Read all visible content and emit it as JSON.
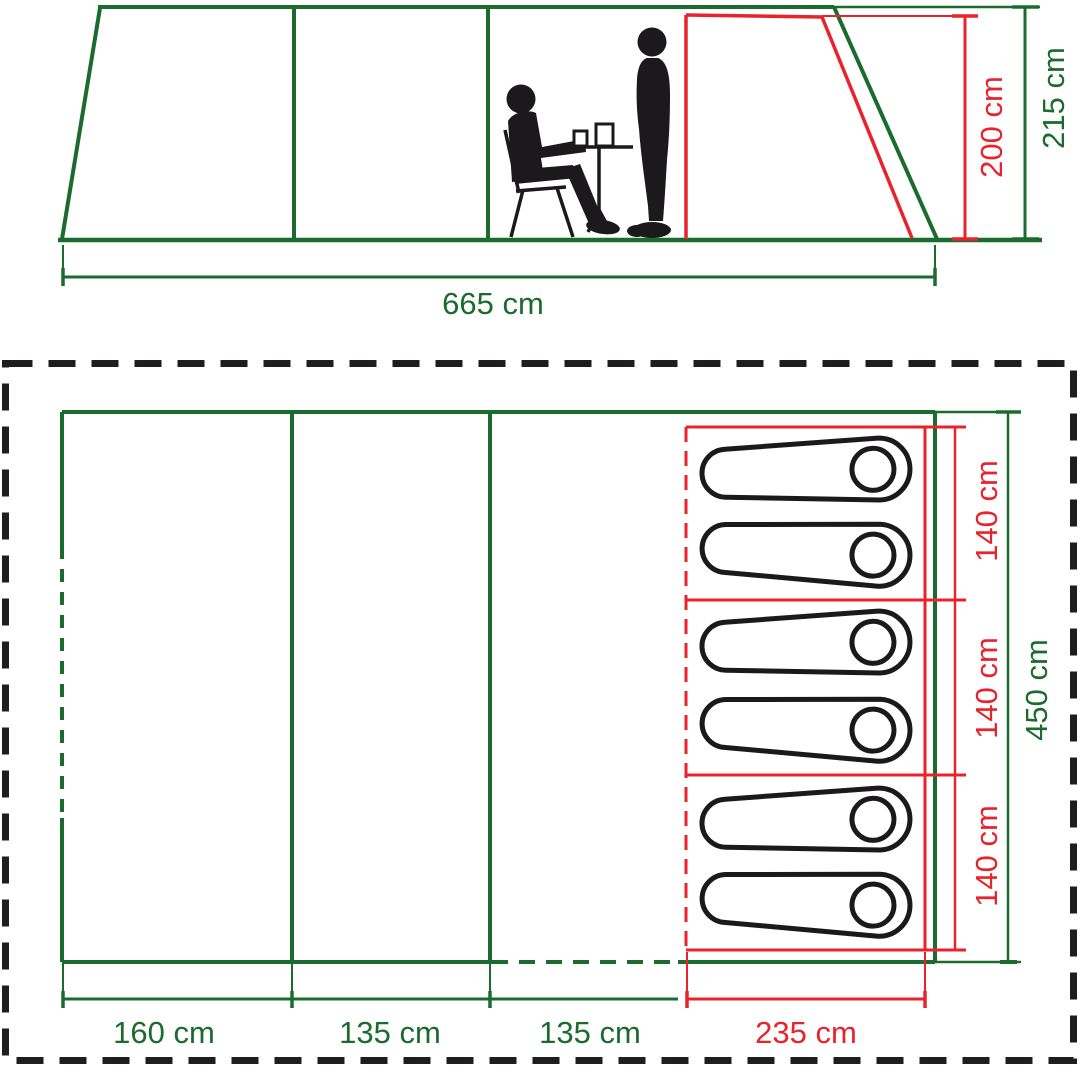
{
  "colors": {
    "green": "#1c6b2e",
    "red": "#e8232b",
    "black": "#1c191c"
  },
  "elevation": {
    "width_label": "665 cm",
    "inner_height_label": "200 cm",
    "outer_height_label": "215 cm"
  },
  "floor_plan": {
    "bottom_labels": [
      "160 cm",
      "135 cm",
      "135 cm",
      "235 cm"
    ],
    "bedroom_section_labels": [
      "140 cm",
      "140 cm",
      "140 cm"
    ],
    "depth_label": "450 cm",
    "sleeping_bag_count": 6
  }
}
